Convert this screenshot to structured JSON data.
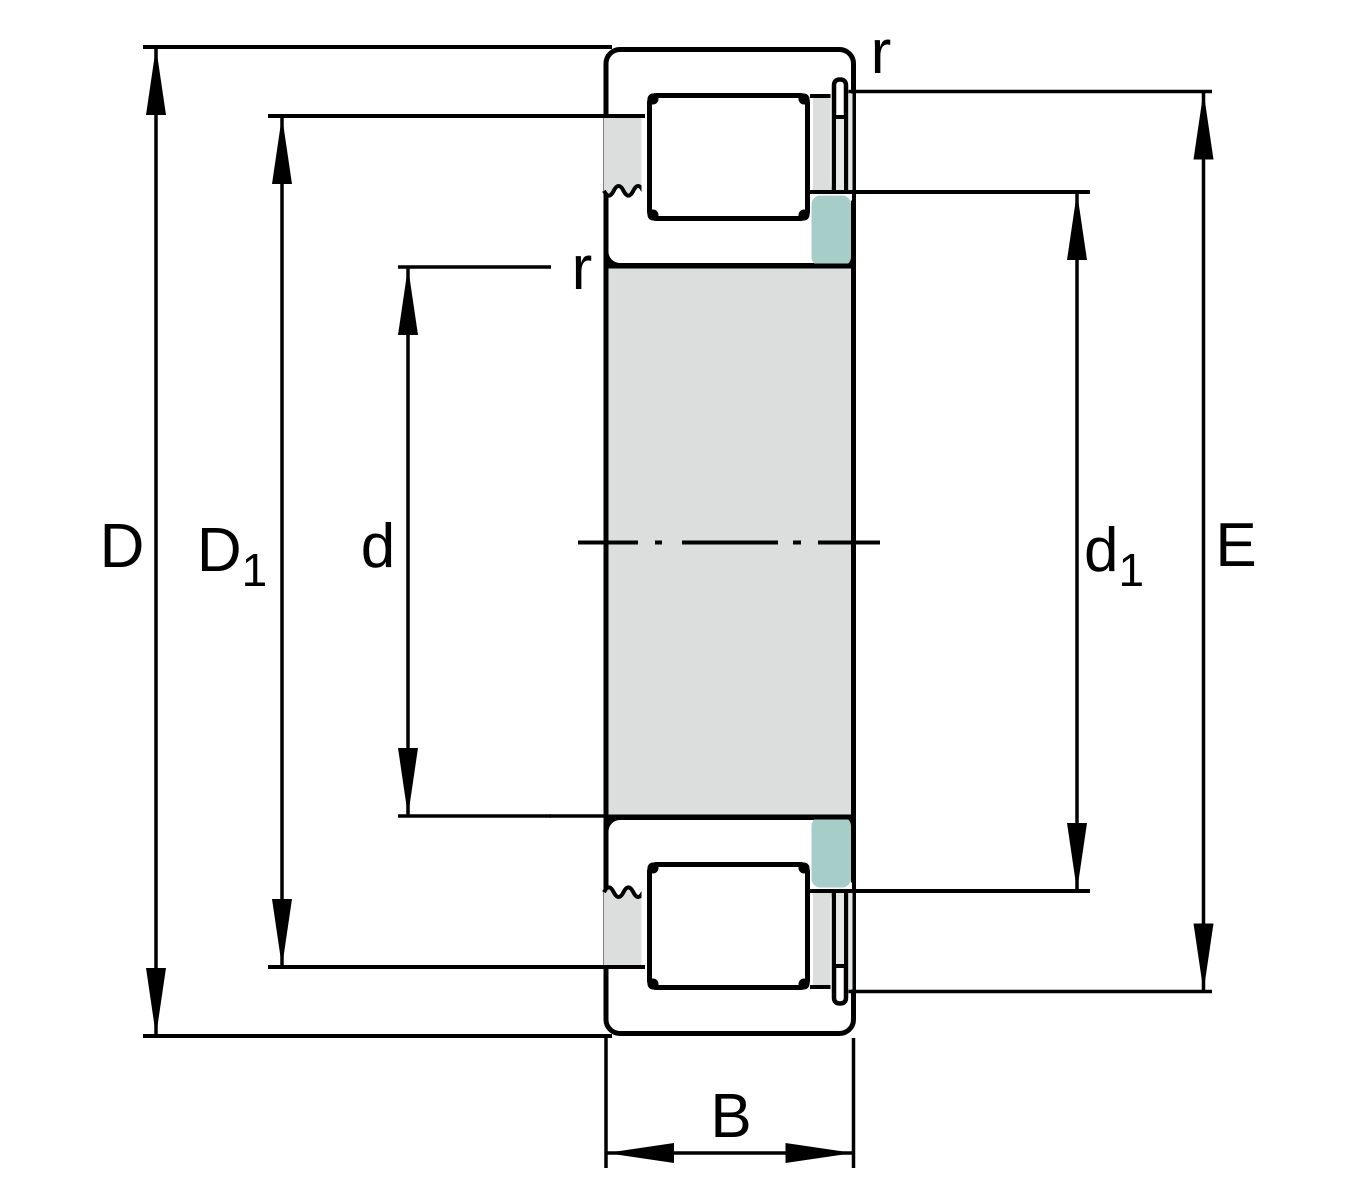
{
  "labels": {
    "D": "D",
    "D1_main": "D",
    "D1_sub": "1",
    "d": "d",
    "d1_main": "d",
    "d1_sub": "1",
    "E": "E",
    "B": "B",
    "r_outer": "r",
    "r_inner": "r"
  },
  "colors": {
    "ring_teal": "#a7cdc9",
    "steel_gray": "#dcdddd",
    "light_gray": "#e5e7e7",
    "gap_white": "#ffffff",
    "outline_black": "#000000",
    "roller_dark": "#6d98a4",
    "roller_mid": "#8fb7be",
    "roller_white": "#ffffff",
    "roller_soft": "#cfe4e7",
    "roller_teal": "#a6ccd1"
  }
}
